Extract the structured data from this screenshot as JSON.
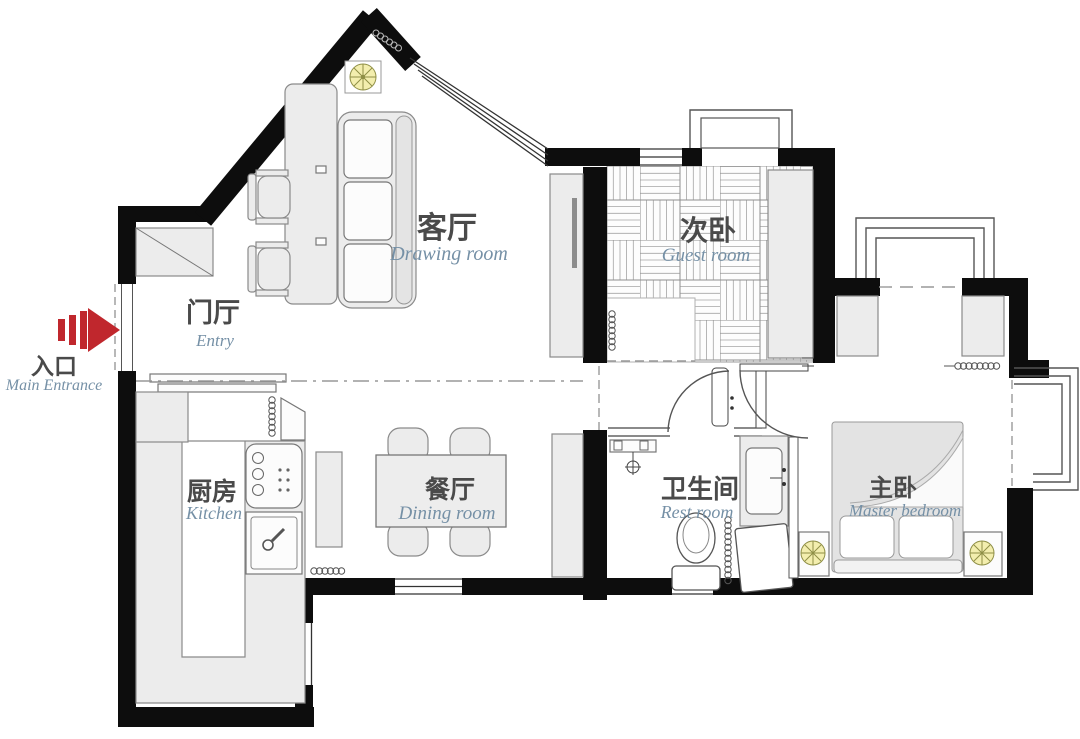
{
  "plan_title": "apartment floor plan",
  "labels": {
    "entry": {
      "zh": "门厅",
      "en": "Entry"
    },
    "main_entrance": {
      "zh": "入口",
      "en": "Main Entrance"
    },
    "drawing_room": {
      "zh": "客厅",
      "en": "Drawing room"
    },
    "guest_room": {
      "zh": "次卧",
      "en": "Guest room"
    },
    "kitchen": {
      "zh": "厨房",
      "en": "Kitchen"
    },
    "dining_room": {
      "zh": "餐厅",
      "en": "Dining room"
    },
    "rest_room": {
      "zh": "卫生间",
      "en": "Rest room"
    },
    "master_bedroom": {
      "zh": "主卧",
      "en": "Master bedroom"
    }
  },
  "icons": {
    "entrance_arrow": "red-arrow-pointing-right",
    "ceiling_lamp": "yellow-circle-with-spokes",
    "bedside_lamps": "yellow-circle-with-spokes"
  },
  "colors": {
    "wall": "#0d0d0d",
    "label_zh": "#4a4a4a",
    "label_en": "#7590a6",
    "arrow_red": "#c0272d",
    "lamp_yellow": "#f3eeae",
    "furniture_fill": "#ececec"
  }
}
